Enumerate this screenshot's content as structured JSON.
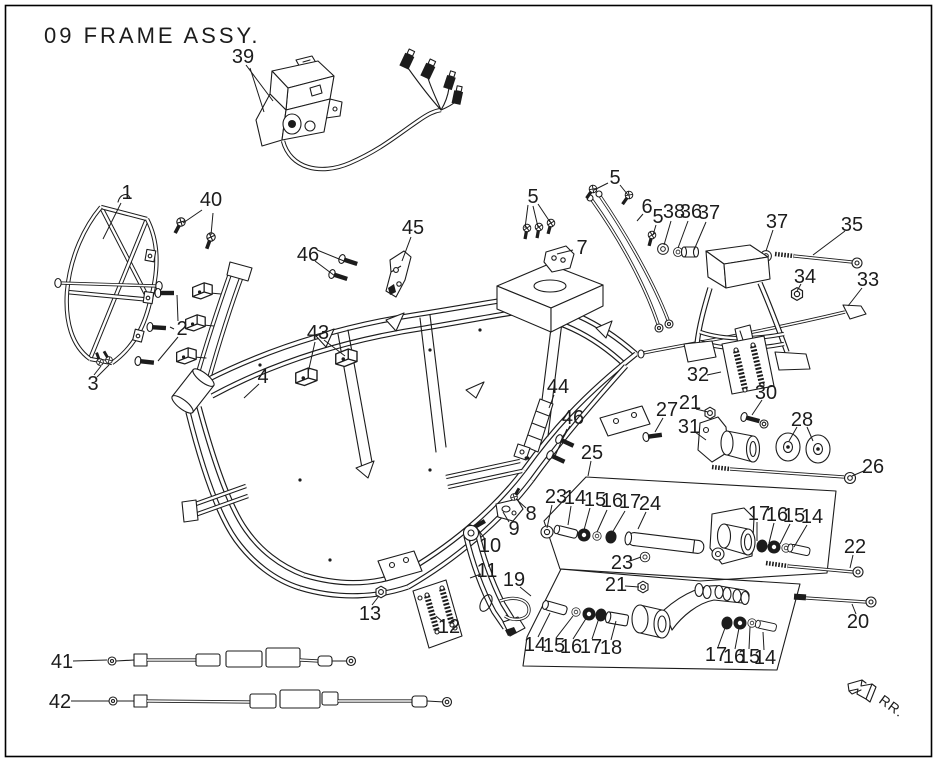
{
  "title": "09  FRAME ASSY.",
  "direction_label": "RR.",
  "colors": {
    "ink": "#1c1c1c",
    "paper": "#ffffff"
  },
  "callouts": [
    {
      "t": "39",
      "x": 243,
      "y": 57,
      "l": [
        [
          246,
          65,
          273,
          101
        ],
        [
          250,
          68,
          264,
          112
        ]
      ]
    },
    {
      "t": "1",
      "x": 127,
      "y": 193,
      "l": [
        [
          121,
          203,
          103,
          239
        ]
      ]
    },
    {
      "t": "40",
      "x": 211,
      "y": 200,
      "l": [
        [
          202,
          210,
          183,
          223
        ],
        [
          213,
          213,
          211,
          235
        ]
      ]
    },
    {
      "t": "46",
      "x": 308,
      "y": 255,
      "l": [
        [
          317,
          250,
          344,
          261
        ],
        [
          315,
          261,
          335,
          276
        ]
      ]
    },
    {
      "t": "45",
      "x": 413,
      "y": 228,
      "l": [
        [
          411,
          237,
          402,
          261
        ]
      ]
    },
    {
      "t": "2",
      "x": 182,
      "y": 329,
      "l": [
        [
          178,
          321,
          177,
          295
        ],
        [
          174,
          329,
          170,
          327
        ],
        [
          178,
          337,
          158,
          361
        ]
      ]
    },
    {
      "t": "43",
      "x": 318,
      "y": 333,
      "l": [
        [
          315,
          342,
          308,
          373
        ],
        [
          324,
          340,
          345,
          356
        ]
      ]
    },
    {
      "t": "3",
      "x": 93,
      "y": 384,
      "l": [
        [
          94,
          375,
          101,
          366
        ],
        [
          97,
          377,
          109,
          365
        ]
      ]
    },
    {
      "t": "4",
      "x": 263,
      "y": 377,
      "l": [
        [
          259,
          384,
          244,
          398
        ]
      ]
    },
    {
      "t": "5",
      "x": 533,
      "y": 197,
      "l": [
        [
          528,
          205,
          525,
          228
        ],
        [
          533,
          206,
          538,
          227
        ],
        [
          538,
          204,
          550,
          222
        ]
      ]
    },
    {
      "t": "7",
      "x": 582,
      "y": 248,
      "l": [
        [
          573,
          250,
          557,
          254
        ]
      ]
    },
    {
      "t": "5",
      "x": 615,
      "y": 178,
      "l": [
        [
          608,
          183,
          594,
          190
        ],
        [
          620,
          185,
          628,
          195
        ]
      ]
    },
    {
      "t": "6",
      "x": 647,
      "y": 207,
      "l": [
        [
          643,
          214,
          637,
          221
        ]
      ]
    },
    {
      "t": "5",
      "x": 658,
      "y": 217,
      "l": [
        [
          656,
          225,
          653,
          235
        ]
      ]
    },
    {
      "t": "38",
      "x": 674,
      "y": 212,
      "l": [
        [
          671,
          221,
          664,
          245
        ]
      ]
    },
    {
      "t": "36",
      "x": 691,
      "y": 212,
      "l": [
        [
          688,
          221,
          678,
          248
        ]
      ]
    },
    {
      "t": "37",
      "x": 709,
      "y": 213,
      "l": [
        [
          706,
          222,
          694,
          250
        ]
      ]
    },
    {
      "t": "37",
      "x": 777,
      "y": 222,
      "l": [
        [
          773,
          230,
          766,
          251
        ]
      ]
    },
    {
      "t": "35",
      "x": 852,
      "y": 225,
      "l": [
        [
          845,
          231,
          813,
          255
        ]
      ]
    },
    {
      "t": "34",
      "x": 805,
      "y": 277,
      "l": [
        [
          801,
          284,
          797,
          291
        ]
      ]
    },
    {
      "t": "33",
      "x": 868,
      "y": 280,
      "l": [
        [
          862,
          288,
          848,
          306
        ]
      ]
    },
    {
      "t": "32",
      "x": 698,
      "y": 375,
      "l": [
        [
          707,
          375,
          721,
          372
        ]
      ]
    },
    {
      "t": "30",
      "x": 766,
      "y": 393,
      "l": [
        [
          762,
          400,
          752,
          415
        ]
      ]
    },
    {
      "t": "27",
      "x": 667,
      "y": 410,
      "l": [
        [
          663,
          418,
          655,
          432
        ]
      ]
    },
    {
      "t": "21",
      "x": 690,
      "y": 403,
      "l": [
        [
          696,
          409,
          708,
          412
        ]
      ]
    },
    {
      "t": "31",
      "x": 689,
      "y": 427,
      "l": [
        [
          695,
          432,
          706,
          440
        ]
      ]
    },
    {
      "t": "28",
      "x": 802,
      "y": 420,
      "l": [
        [
          797,
          427,
          789,
          441
        ],
        [
          807,
          427,
          813,
          441
        ]
      ]
    },
    {
      "t": "26",
      "x": 873,
      "y": 467,
      "l": [
        [
          866,
          470,
          852,
          476
        ]
      ]
    },
    {
      "t": "44",
      "x": 558,
      "y": 387,
      "l": [
        [
          554,
          395,
          549,
          408
        ]
      ]
    },
    {
      "t": "46",
      "x": 573,
      "y": 418,
      "l": [
        [
          570,
          426,
          562,
          440
        ],
        [
          567,
          429,
          555,
          456
        ]
      ]
    },
    {
      "t": "25",
      "x": 592,
      "y": 453,
      "l": [
        [
          591,
          461,
          588,
          476
        ]
      ]
    },
    {
      "t": "23",
      "x": 556,
      "y": 497,
      "l": [
        [
          552,
          505,
          547,
          528
        ]
      ]
    },
    {
      "t": "14",
      "x": 575,
      "y": 498,
      "l": [
        [
          571,
          506,
          568,
          525
        ]
      ]
    },
    {
      "t": "15",
      "x": 595,
      "y": 500,
      "l": [
        [
          590,
          508,
          584,
          530
        ]
      ]
    },
    {
      "t": "16",
      "x": 612,
      "y": 501,
      "l": [
        [
          607,
          510,
          597,
          532
        ]
      ]
    },
    {
      "t": "17",
      "x": 630,
      "y": 502,
      "l": [
        [
          625,
          511,
          612,
          533
        ]
      ]
    },
    {
      "t": "24",
      "x": 650,
      "y": 504,
      "l": [
        [
          646,
          512,
          638,
          529
        ]
      ]
    },
    {
      "t": "17",
      "x": 759,
      "y": 514,
      "l": [
        [
          757,
          522,
          757,
          541
        ]
      ]
    },
    {
      "t": "16",
      "x": 777,
      "y": 515,
      "l": [
        [
          774,
          523,
          769,
          543
        ]
      ]
    },
    {
      "t": "15",
      "x": 794,
      "y": 516,
      "l": [
        [
          790,
          524,
          780,
          544
        ]
      ]
    },
    {
      "t": "14",
      "x": 812,
      "y": 517,
      "l": [
        [
          807,
          525,
          794,
          547
        ]
      ]
    },
    {
      "t": "22",
      "x": 855,
      "y": 547,
      "l": [
        [
          853,
          555,
          850,
          568
        ]
      ]
    },
    {
      "t": "20",
      "x": 858,
      "y": 622,
      "l": [
        [
          856,
          614,
          852,
          604
        ]
      ]
    },
    {
      "t": "8",
      "x": 531,
      "y": 514,
      "l": [
        [
          526,
          508,
          516,
          499
        ]
      ]
    },
    {
      "t": "9",
      "x": 514,
      "y": 529,
      "l": [
        [
          509,
          522,
          503,
          512
        ]
      ]
    },
    {
      "t": "10",
      "x": 490,
      "y": 546,
      "l": [
        [
          485,
          539,
          477,
          528
        ]
      ]
    },
    {
      "t": "11",
      "x": 487,
      "y": 571,
      "l": [
        [
          481,
          574,
          470,
          578
        ]
      ]
    },
    {
      "t": "19",
      "x": 514,
      "y": 580,
      "l": [
        [
          520,
          587,
          531,
          596
        ]
      ]
    },
    {
      "t": "13",
      "x": 370,
      "y": 614,
      "l": [
        [
          372,
          605,
          379,
          596
        ]
      ]
    },
    {
      "t": "12",
      "x": 449,
      "y": 627,
      "l": [
        [
          443,
          622,
          436,
          616
        ]
      ]
    },
    {
      "t": "23",
      "x": 622,
      "y": 563,
      "l": [
        [
          630,
          561,
          641,
          557
        ]
      ]
    },
    {
      "t": "21",
      "x": 616,
      "y": 585,
      "l": [
        [
          625,
          586,
          639,
          587
        ]
      ]
    },
    {
      "t": "14",
      "x": 535,
      "y": 645,
      "l": [
        [
          538,
          637,
          550,
          613
        ]
      ]
    },
    {
      "t": "15",
      "x": 554,
      "y": 646,
      "l": [
        [
          556,
          638,
          573,
          616
        ]
      ]
    },
    {
      "t": "16",
      "x": 571,
      "y": 647,
      "l": [
        [
          573,
          639,
          587,
          617
        ]
      ]
    },
    {
      "t": "17",
      "x": 591,
      "y": 647,
      "l": [
        [
          592,
          639,
          599,
          618
        ]
      ]
    },
    {
      "t": "18",
      "x": 611,
      "y": 648,
      "l": [
        [
          611,
          640,
          616,
          621
        ]
      ]
    },
    {
      "t": "17",
      "x": 716,
      "y": 655,
      "l": [
        [
          718,
          647,
          725,
          628
        ]
      ]
    },
    {
      "t": "16",
      "x": 734,
      "y": 657,
      "l": [
        [
          735,
          649,
          739,
          628
        ]
      ]
    },
    {
      "t": "15",
      "x": 749,
      "y": 657,
      "l": [
        [
          749,
          649,
          750,
          627
        ]
      ]
    },
    {
      "t": "14",
      "x": 765,
      "y": 658,
      "l": [
        [
          764,
          650,
          763,
          632
        ]
      ]
    },
    {
      "t": "41",
      "x": 62,
      "y": 662,
      "l": [
        [
          73,
          661,
          107,
          660
        ]
      ]
    },
    {
      "t": "42",
      "x": 60,
      "y": 702,
      "l": [
        [
          71,
          701,
          109,
          701
        ]
      ]
    }
  ]
}
